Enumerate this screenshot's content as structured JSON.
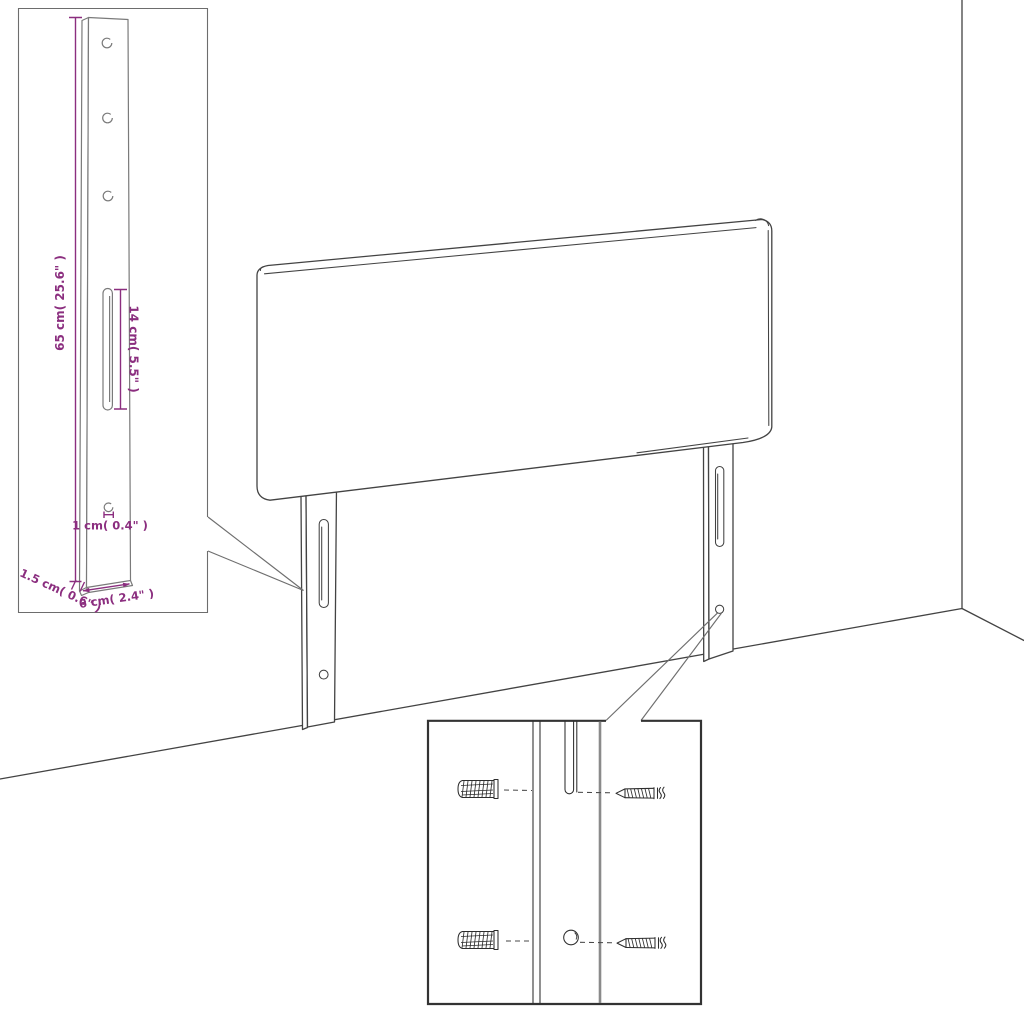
{
  "colors": {
    "accent": "#8B2E7F",
    "line": "#434343",
    "background": "#FFFFFF"
  },
  "bracket_inset": {
    "labels": {
      "height": "65 cm( 25.6\" )",
      "slot_length": "14 cm( 5.5\" )",
      "hole_diameter": "1 cm( 0.4\" )",
      "thickness": "1.5 cm( 0.6\" )",
      "width": "6 cm( 2.4\" )"
    }
  }
}
